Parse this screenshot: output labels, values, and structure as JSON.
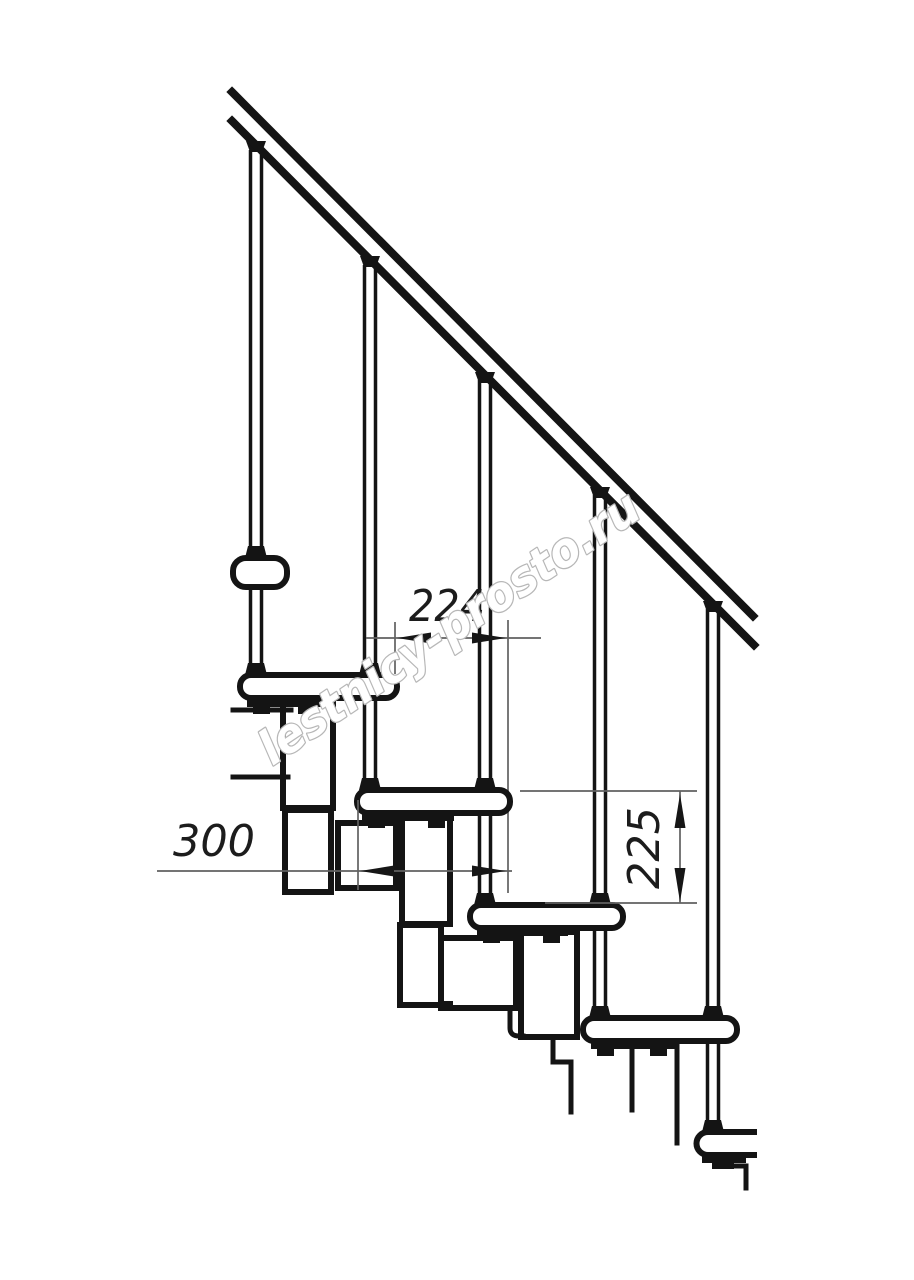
{
  "watermark": {
    "text": "lestnicy-prosto.ru"
  },
  "dimensions": {
    "run_horizontal": "224",
    "tread_depth": "300",
    "rise_vertical": "225"
  },
  "colors": {
    "line": "#141414",
    "dimension_line": "#616161",
    "dimension_text": "#1c1c1c",
    "watermark_outline": "#b7b7b7",
    "background": "#ffffff"
  }
}
